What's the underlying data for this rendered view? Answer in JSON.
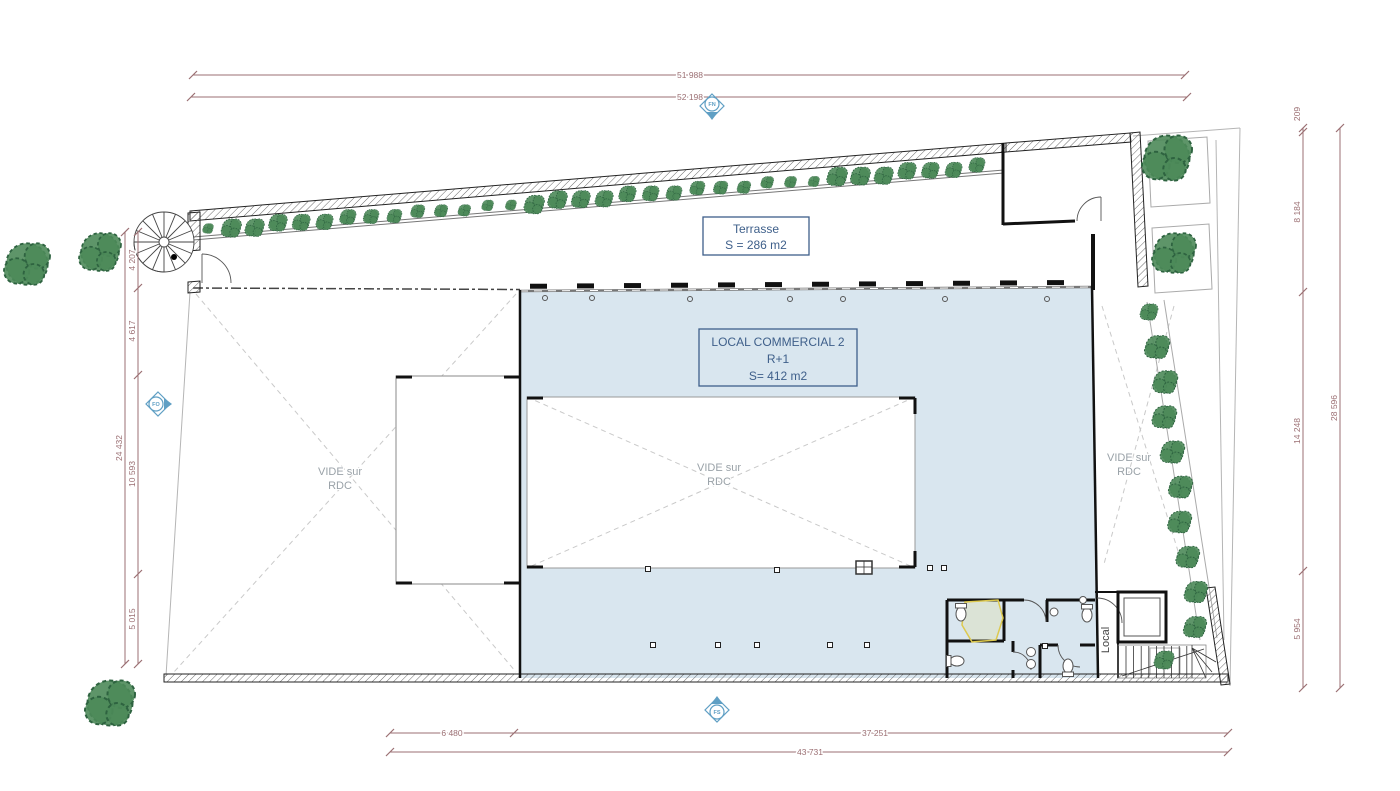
{
  "colors": {
    "room_fill": "#d9e6ef",
    "label_blue": "#3e5f8a",
    "dim_color": "#9b6f73",
    "vide_gray": "#9aa2a8",
    "tree_green": "#4d8a59",
    "tree_stroke": "#2e6340",
    "marker_blue": "#5f9fc4",
    "highlight_yellow": "#ddc94f",
    "wall_black": "#1a1a1a"
  },
  "labels": {
    "terrasse": {
      "title": "Terrasse",
      "area": "S = 286 m2"
    },
    "local_commercial": {
      "title": "LOCAL COMMERCIAL 2",
      "level": "R+1",
      "area": "S= 412 m2"
    },
    "vide": {
      "line1": "VIDE sur",
      "line2": "RDC"
    },
    "local_room": "Local"
  },
  "dimensions": {
    "top": {
      "line1": "51 988",
      "line2": "52 198"
    },
    "bottom": {
      "seg1": "6 480",
      "seg2": "37 251",
      "total": "43 731"
    },
    "left": {
      "total": "24 432",
      "seg1": "4 207",
      "seg2": "4 617",
      "seg3": "10 593",
      "seg4": "5 015"
    },
    "right": {
      "seg1": "209",
      "seg2": "8 184",
      "seg3": "14 248",
      "seg4": "5 954",
      "total": "28 596"
    }
  },
  "markers": {
    "north": "FN",
    "west": "FO",
    "south": "FS"
  }
}
